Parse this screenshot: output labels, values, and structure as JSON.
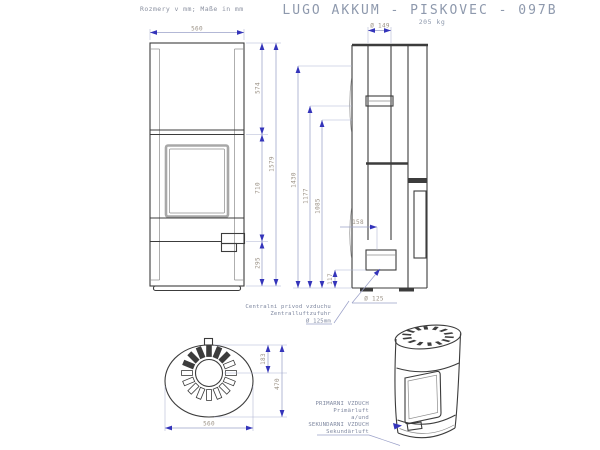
{
  "header": {
    "units_note": "Rozmery v mm; Maße in mm",
    "title": "LUGO AKKUM - PISKOVEC - 097B",
    "weight": "205 kg"
  },
  "front_view": {
    "width_top": "560",
    "upper_section_height": "574",
    "door_section_height": "710",
    "base_section_height": "295",
    "total_height": "1579"
  },
  "side_view": {
    "flue_diameter": "Ø 149",
    "height_1430": "1430",
    "height_1177": "1177",
    "height_1085": "1085",
    "inlet_offset": "158",
    "inlet_height": "117",
    "inlet_diameter": "Ø 125",
    "air_label_line1": "Centralni privod vzduchu",
    "air_label_line2": "Zentralluftzufuhr",
    "air_label_line3": "Ø 125mm"
  },
  "top_view": {
    "flue_offset": "183",
    "depth": "470",
    "width": "560"
  },
  "iso_view": {
    "label_line1": "PRIMARNI VZDUCH",
    "label_line2": "Primärluft",
    "label_line3": "a/und",
    "label_line4": "SEKUNDARNI VZDUCH",
    "label_line5": "Sekundärluft"
  },
  "colors": {
    "geometry_line": "#3c3c3c",
    "dimension_arrow": "#3434ba",
    "dimension_text": "#9b9286",
    "label_text": "#7f88a0",
    "title_text": "#8e99ad",
    "background": "#ffffff"
  }
}
